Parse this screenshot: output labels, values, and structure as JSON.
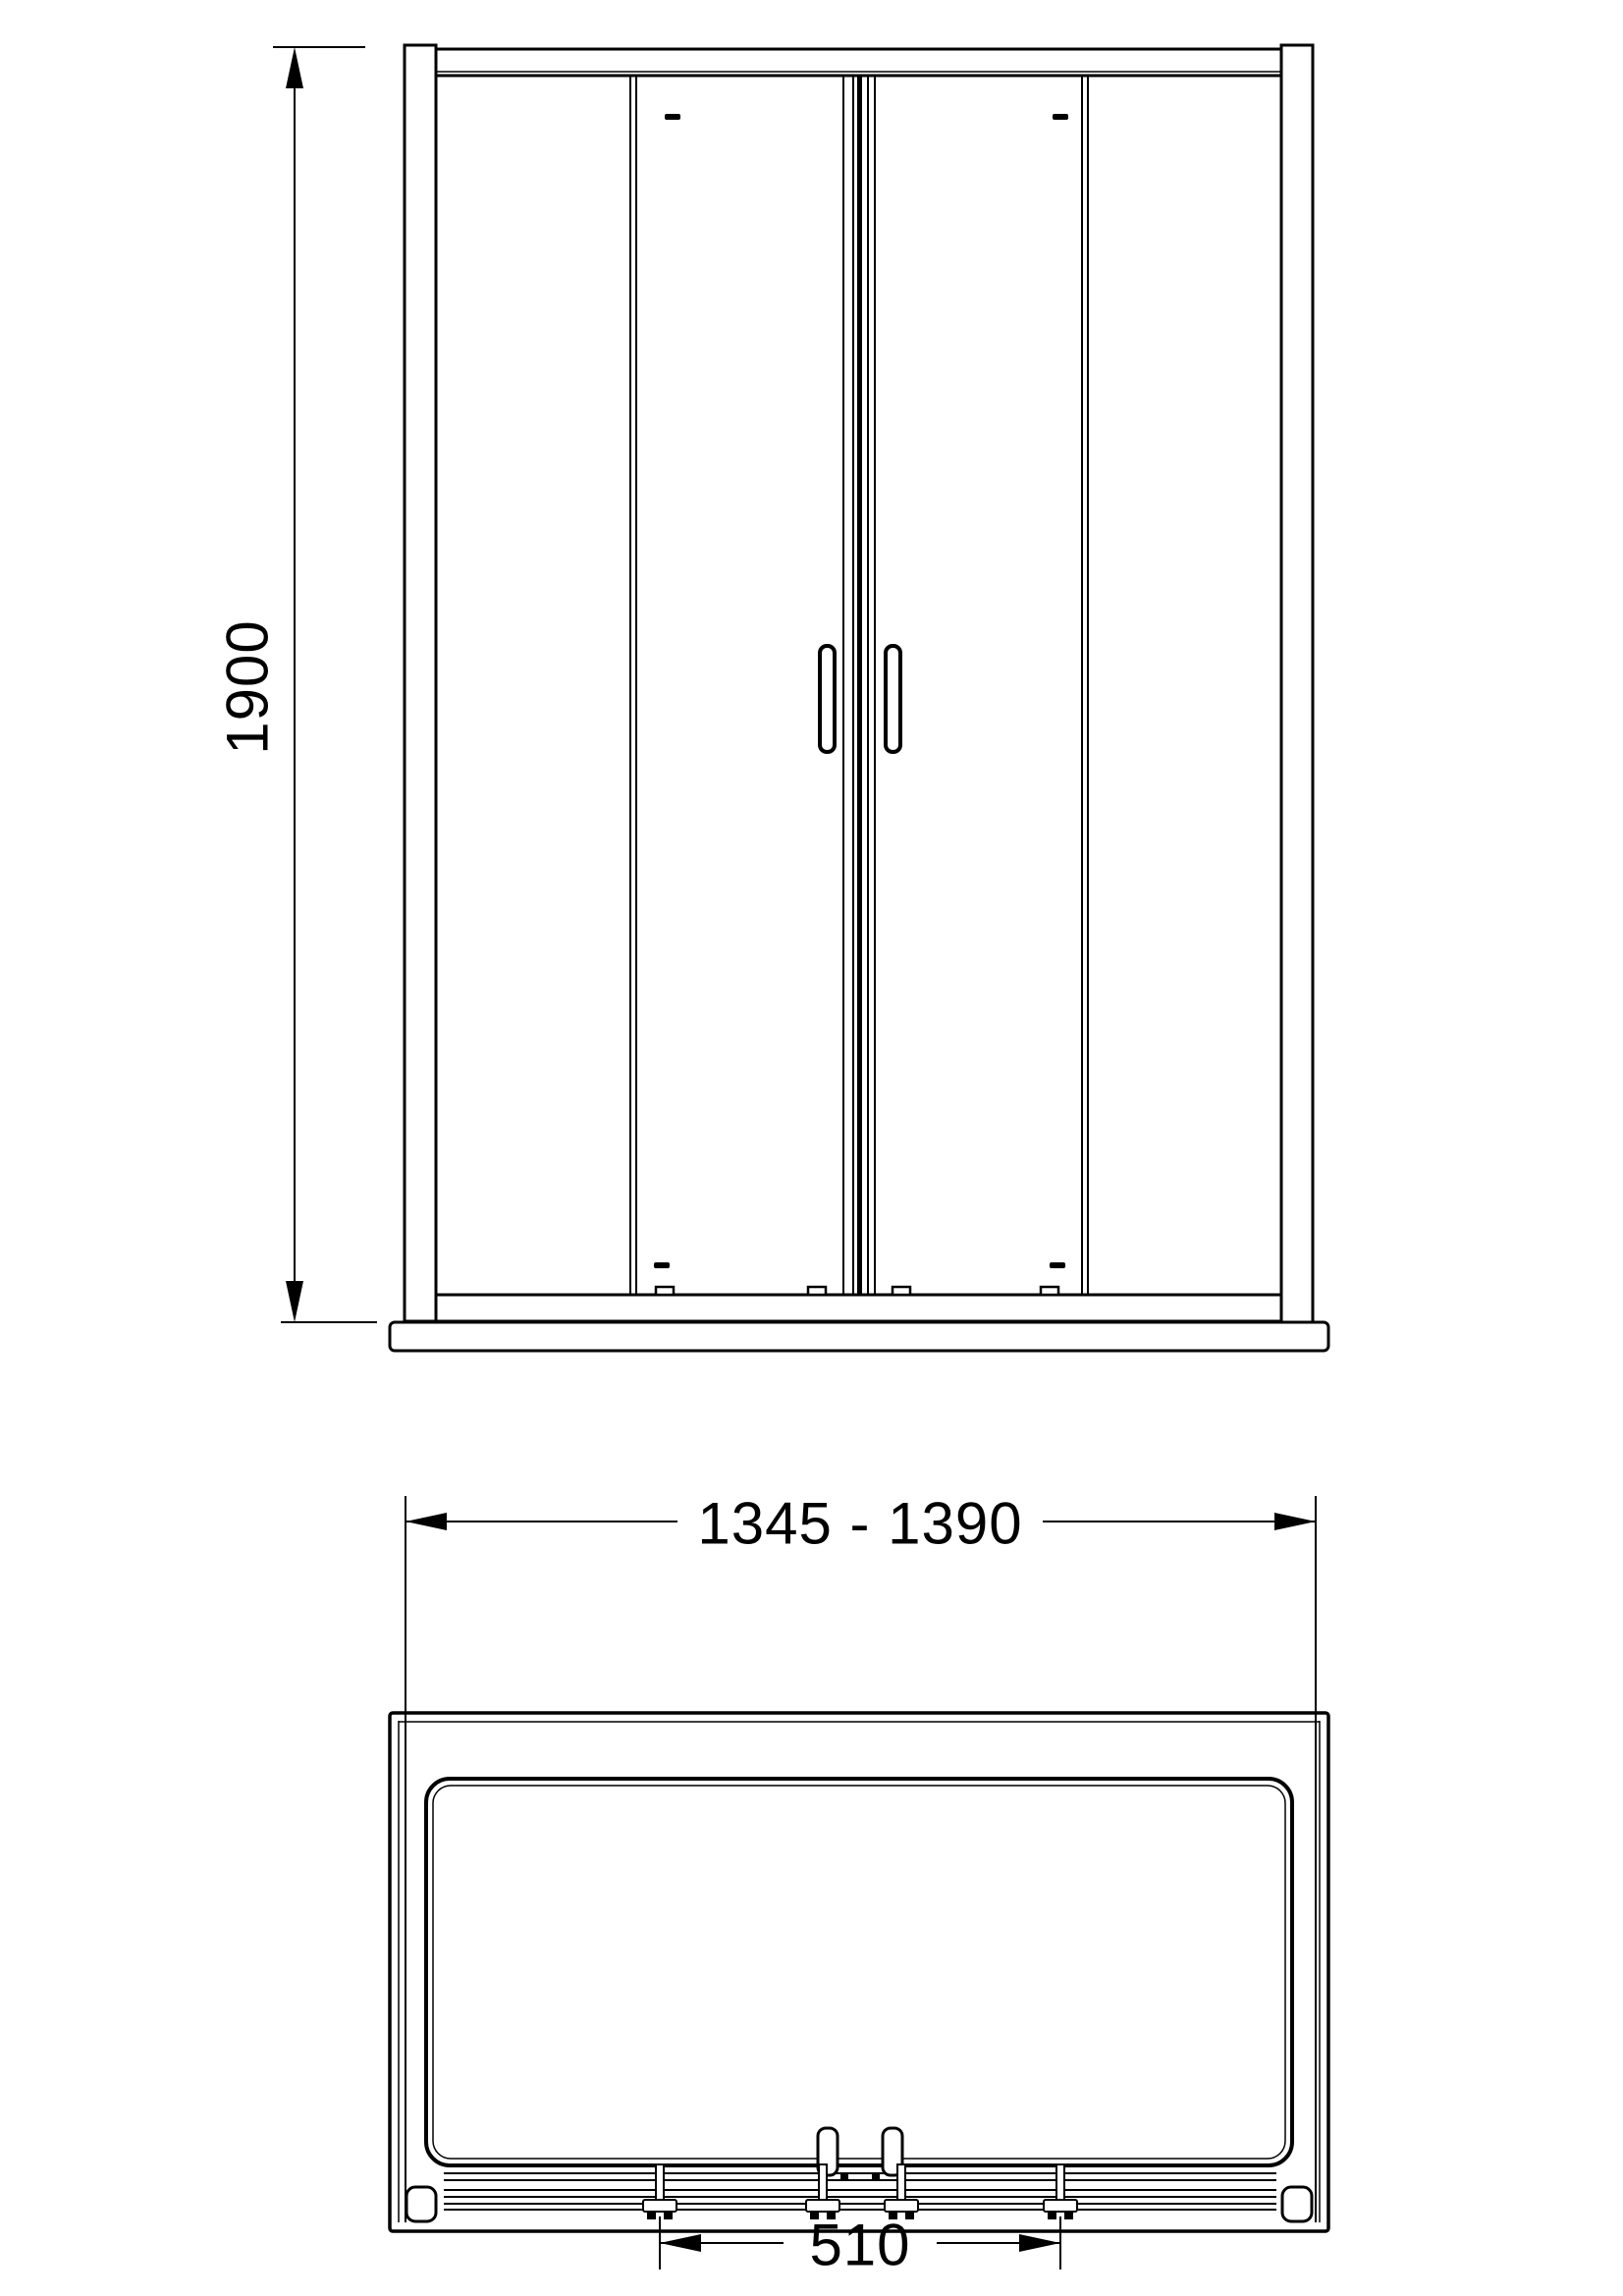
{
  "drawing": {
    "front_view": {
      "height_dimension": "1900"
    },
    "plan_view": {
      "width_dimension": "1345 - 1390",
      "opening_dimension": "510"
    },
    "colors": {
      "line": "#000000",
      "background": "#ffffff"
    }
  }
}
